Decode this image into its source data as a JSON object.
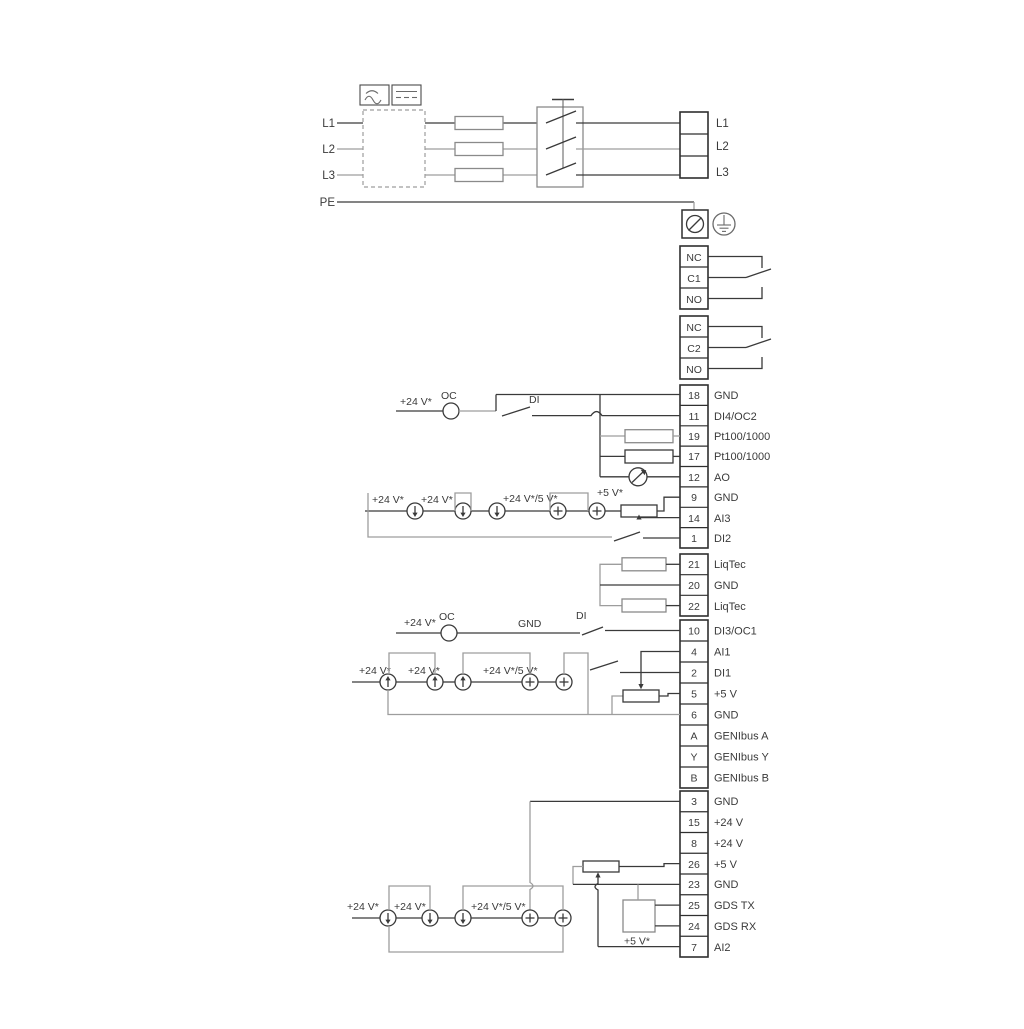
{
  "power": {
    "left_labels": [
      "L1",
      "L2",
      "L3",
      "PE"
    ],
    "terminal_labels": [
      "L1",
      "L2",
      "L3"
    ]
  },
  "relay1": {
    "rows": [
      "NC",
      "C1",
      "NO"
    ]
  },
  "relay2": {
    "rows": [
      "NC",
      "C2",
      "NO"
    ]
  },
  "strip_a": {
    "rows": [
      {
        "num": "18",
        "label": "GND"
      },
      {
        "num": "11",
        "label": "DI4/OC2"
      },
      {
        "num": "19",
        "label": "Pt100/1000"
      },
      {
        "num": "17",
        "label": "Pt100/1000"
      },
      {
        "num": "12",
        "label": "AO"
      },
      {
        "num": "9",
        "label": "GND"
      },
      {
        "num": "14",
        "label": "AI3"
      },
      {
        "num": "1",
        "label": "DI2"
      }
    ]
  },
  "liqtec_strip": {
    "rows": [
      {
        "num": "21",
        "label": "LiqTec"
      },
      {
        "num": "20",
        "label": "GND"
      },
      {
        "num": "22",
        "label": "LiqTec"
      }
    ]
  },
  "strip_b": {
    "rows": [
      {
        "num": "10",
        "label": "DI3/OC1"
      },
      {
        "num": "4",
        "label": "AI1"
      },
      {
        "num": "2",
        "label": "DI1"
      },
      {
        "num": "5",
        "label": "+5 V"
      },
      {
        "num": "6",
        "label": "GND"
      },
      {
        "num": "A",
        "label": "GENIbus A"
      },
      {
        "num": "Y",
        "label": "GENIbus Y"
      },
      {
        "num": "B",
        "label": "GENIbus B"
      }
    ]
  },
  "strip_c": {
    "rows": [
      {
        "num": "3",
        "label": "GND"
      },
      {
        "num": "15",
        "label": "+24 V"
      },
      {
        "num": "8",
        "label": "+24 V"
      },
      {
        "num": "26",
        "label": "+5 V"
      },
      {
        "num": "23",
        "label": "GND"
      },
      {
        "num": "25",
        "label": "GDS TX"
      },
      {
        "num": "24",
        "label": "GDS RX"
      },
      {
        "num": "7",
        "label": "AI2"
      }
    ]
  },
  "ann": {
    "v24": "+24 V*",
    "v24v5": "+24 V*/5 V*",
    "v5": "+5 V*",
    "oc": "OC",
    "di": "DI",
    "gnd": "GND"
  },
  "colors": {
    "wire": "#3a3a3a",
    "wire_gray": "#9d9d9d",
    "terminal_border": "#2f2f2f",
    "background": "#ffffff"
  }
}
